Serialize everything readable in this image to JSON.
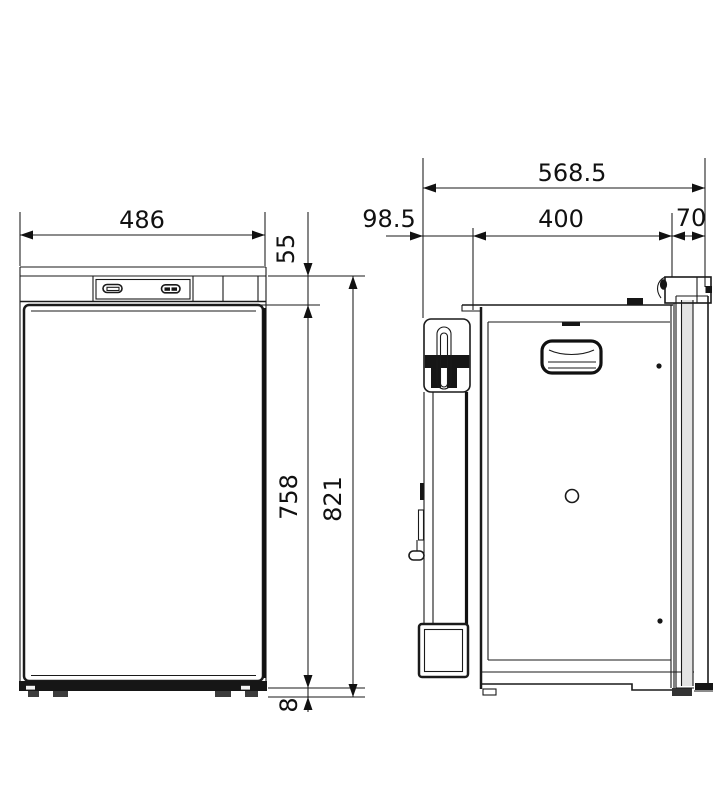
{
  "front_view": {
    "width": "486",
    "top_section_height": "55",
    "door_height": "758",
    "total_height": "821",
    "plinth_height": "8"
  },
  "side_view": {
    "total_depth": "568.5",
    "rear_section_depth": "98.5",
    "recess_depth": "400",
    "door_thickness": "70"
  }
}
